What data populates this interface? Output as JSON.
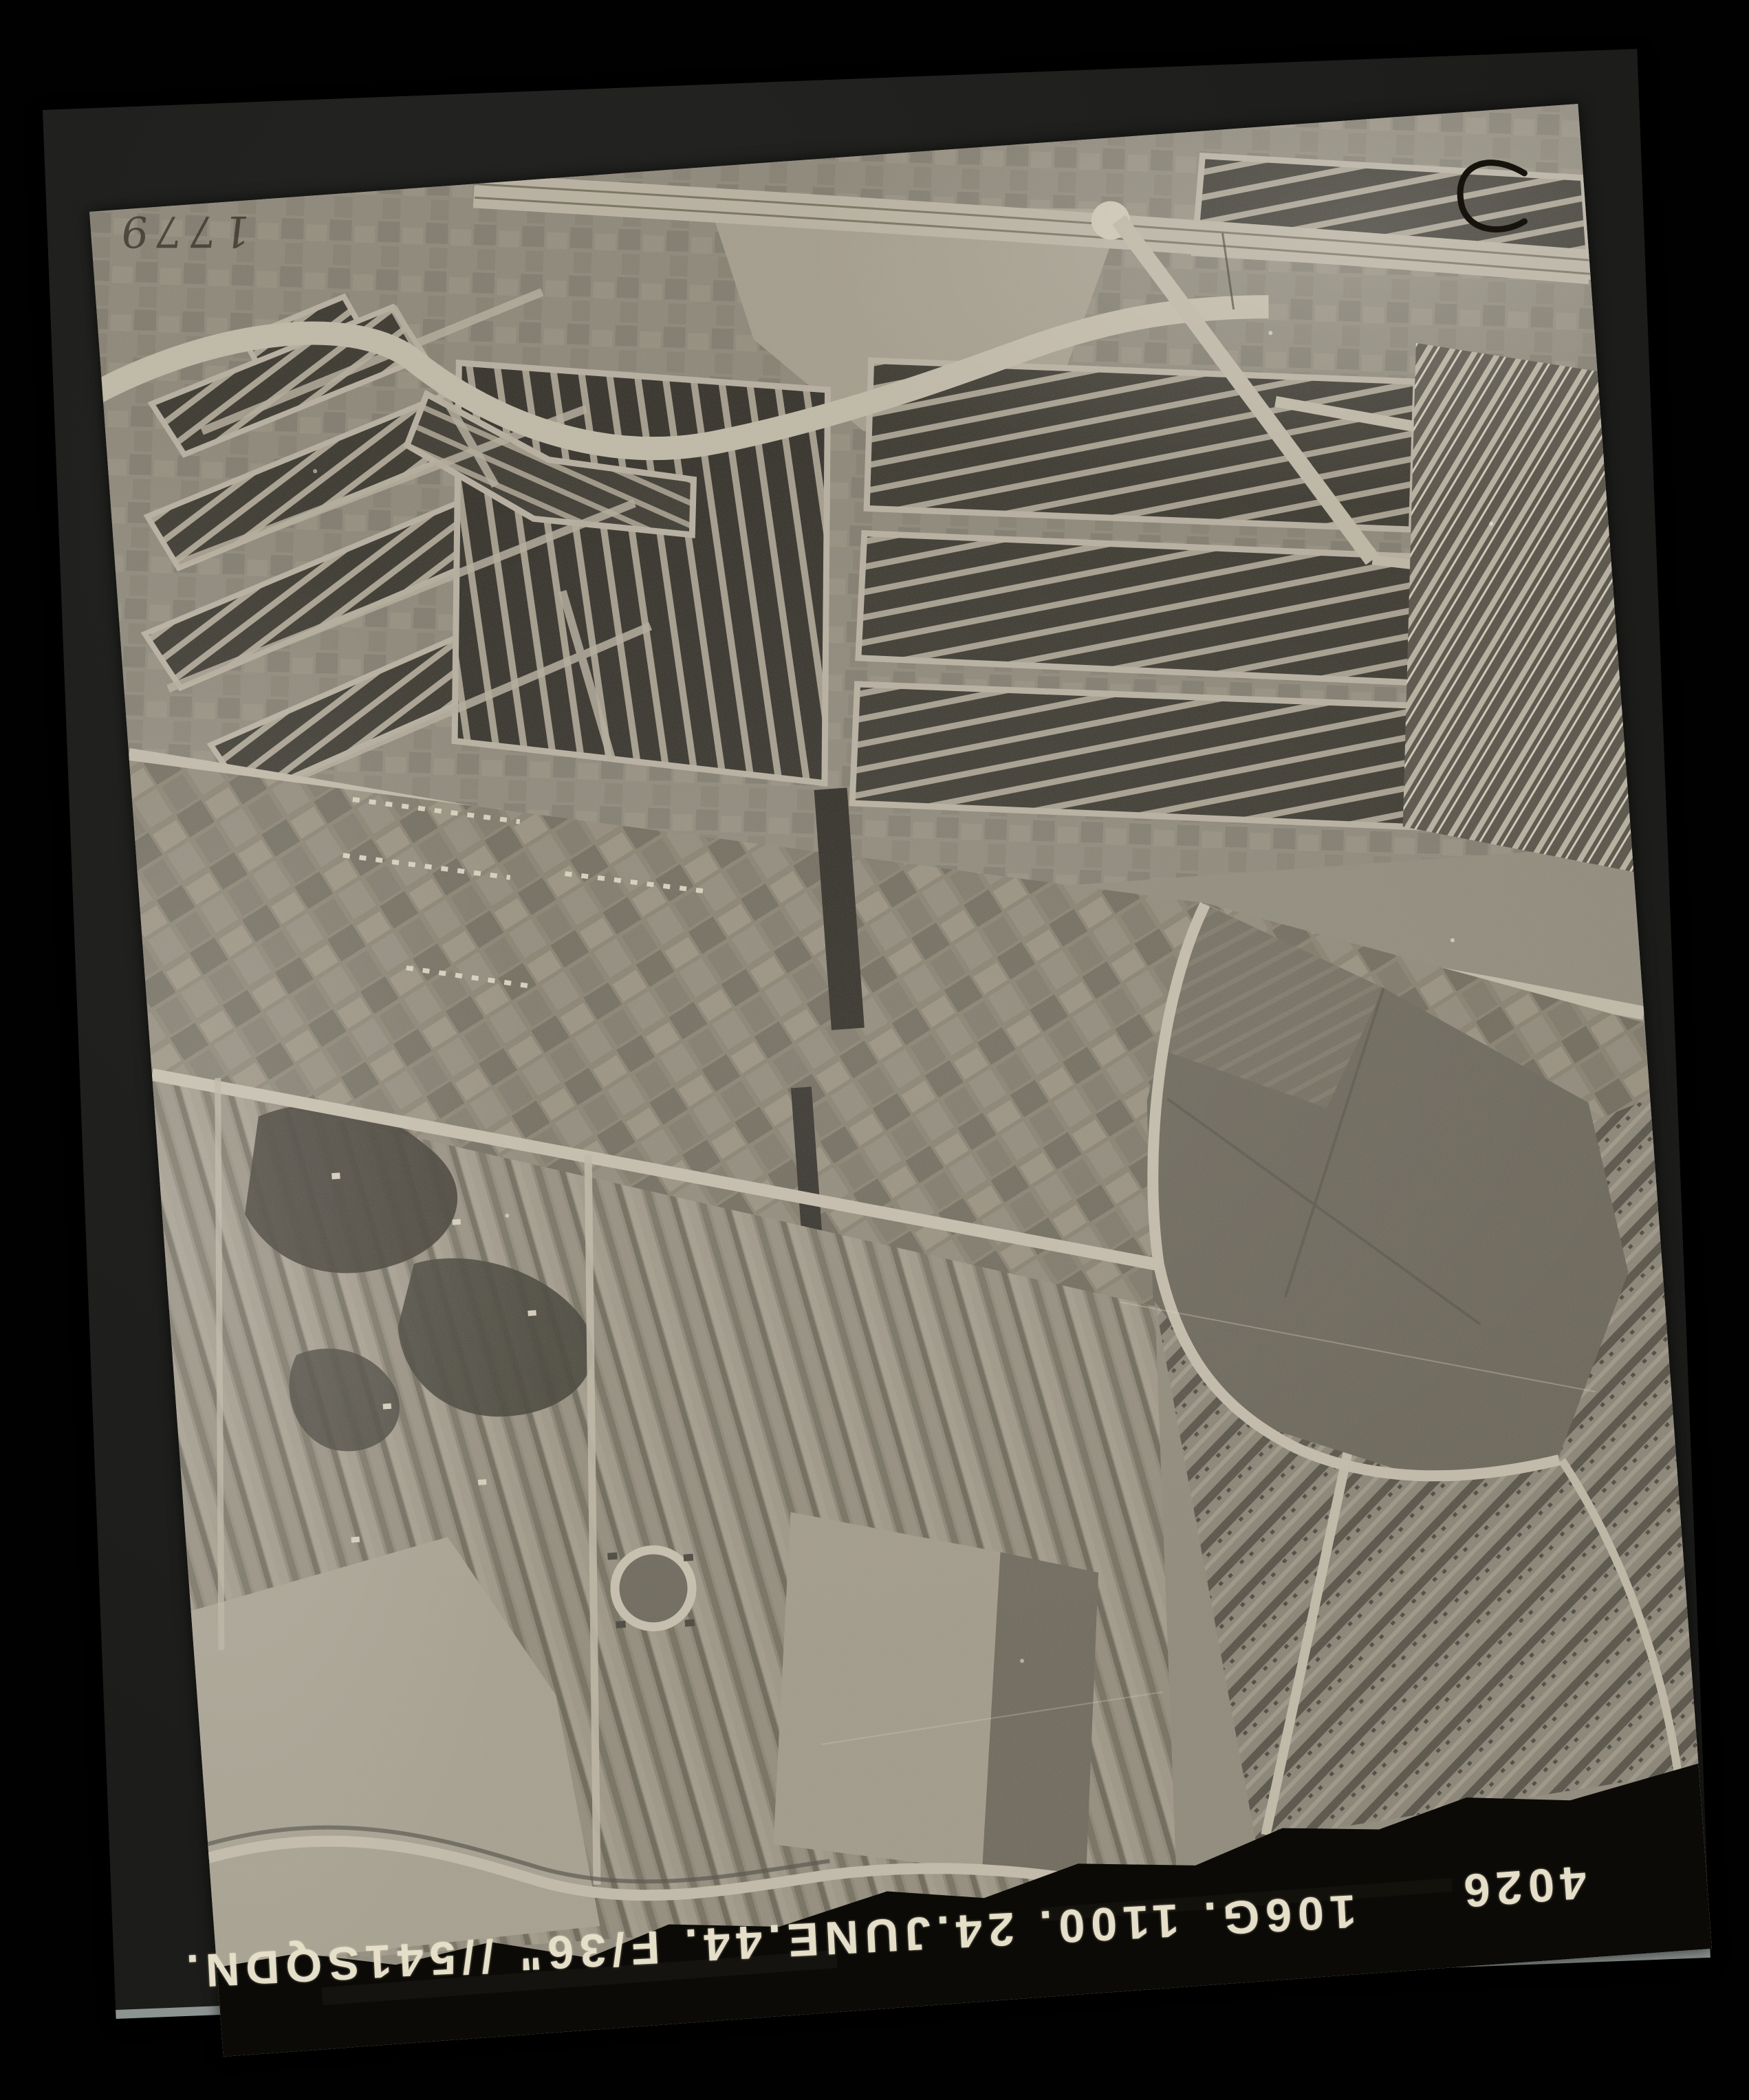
{
  "scan": {
    "frame_number": "4026",
    "annotation": "106G. 1100. 24.JUNE.44. F/36\" //541SQDN.",
    "handwritten_number": "1779",
    "corner_mark": "C",
    "caption_orientation": "printed upside-down in black margin",
    "colors": {
      "scan_background": "#010101",
      "album_page": "#1d1d1b",
      "page_bottom_edge": "#8c9492",
      "photo_light": "#b4ad9d",
      "photo_mid": "#8f8a7b",
      "photo_dark_blocks": "#3a372f",
      "caption_band": "#0b0a07",
      "caption_text": "#e5dec8"
    }
  }
}
